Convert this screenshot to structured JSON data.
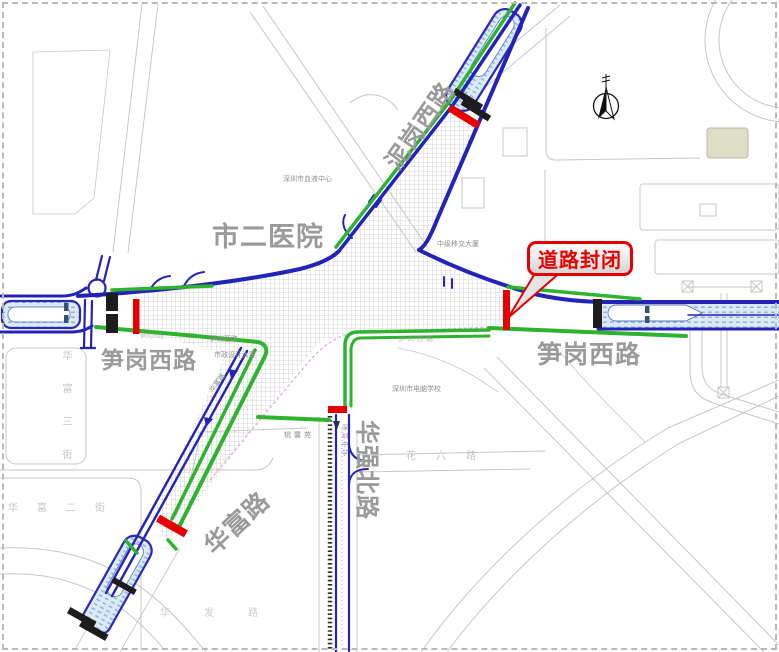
{
  "callout": {
    "label": "道路封闭"
  },
  "labels": {
    "hospital": "市二医院",
    "nigang_west_road": "泥岗西路",
    "sungang_west_left": "笋岗西路",
    "sungang_west_right": "笋岗西路",
    "huafu_road": "华富路",
    "huaqiang_north_road": "华强北路"
  },
  "minor_labels": {
    "blood_center": "深圳市血液中心",
    "building_ne": "中级移交大厦",
    "sungang_small": "笋岗西路",
    "sungang_small_faint": "笋岗西路",
    "design_building": "市政设计大厦",
    "huafu_small": "华富路",
    "computer_school": "深圳市电脑学校",
    "residence": "桃馨苑",
    "middle_school": "深圳中学",
    "huafu_3rd_street": "华富三街",
    "huafu_2nd_street": "华富二街",
    "hua_liu_road": "花六路",
    "hua_fa_road": "华发路"
  },
  "colors": {
    "closure_red": "#e60000",
    "route_green": "#2db32d",
    "road_blue": "#2323b8",
    "bus_fill": "#d9e8f7",
    "label_gray": "#9a9a9a"
  }
}
